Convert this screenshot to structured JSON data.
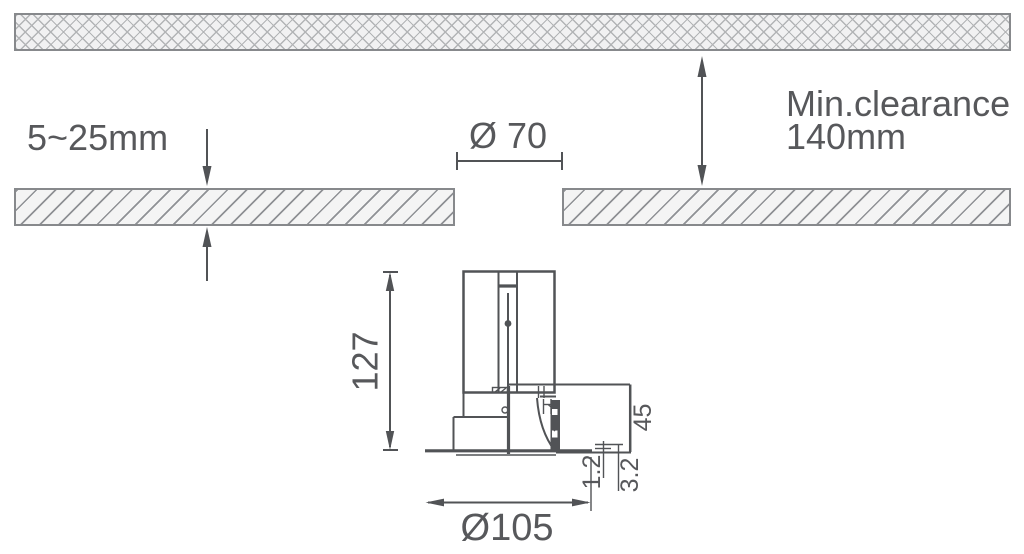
{
  "diagram": {
    "annotations": {
      "ceiling_thickness": "5~25mm",
      "cutout_diameter": "Ø 70",
      "min_clearance_line1": "Min.clearance",
      "min_clearance_line2": "140mm",
      "fixture_height": "127",
      "driver_height": "45",
      "trim_plate_thickness": "1.2",
      "trim_protrusion": "3.2",
      "trim_diameter": "Ø105"
    },
    "colors": {
      "background": "#ffffff",
      "line": "#515356",
      "text": "#57585b",
      "hatch_border": "#87898c",
      "hatch_line": "#8f9195",
      "crosshatch_line": "#b2b4b6",
      "band_fill": "#f1f1f2"
    }
  }
}
